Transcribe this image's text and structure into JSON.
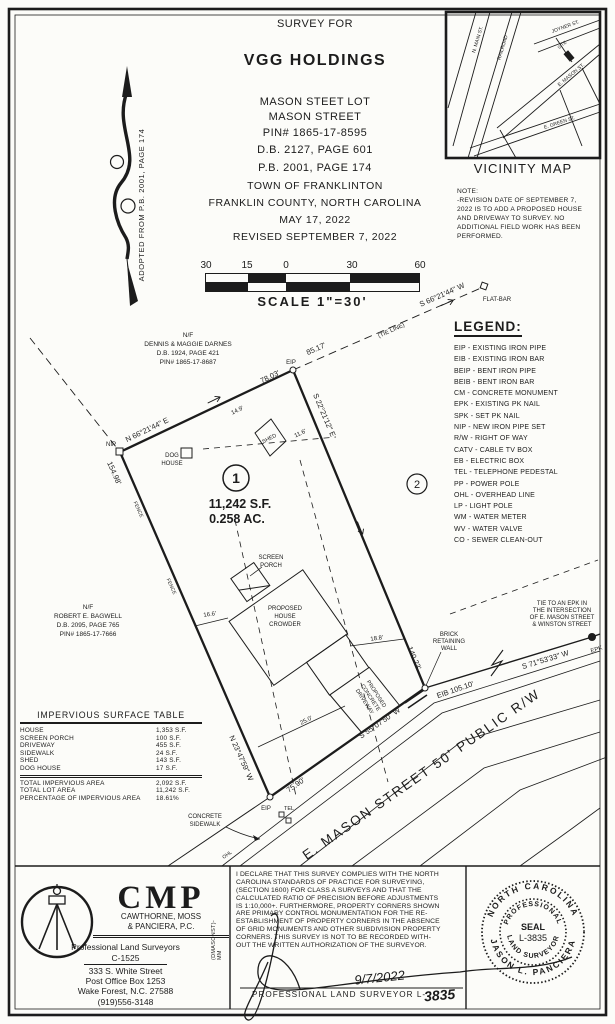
{
  "title_block": {
    "survey_for": "SURVEY FOR",
    "client": "VGG HOLDINGS",
    "lot": "MASON STEET LOT",
    "street": "MASON STREET",
    "pin": "PIN# 1865-17-8595",
    "db": "D.B. 2127, PAGE 601",
    "pb": "P.B. 2001, PAGE 174",
    "town": "TOWN OF FRANKLINTON",
    "county": "FRANKLIN COUNTY, NORTH CAROLINA",
    "date": "MAY 17, 2022",
    "revised": "REVISED SEPTEMBER 7, 2022"
  },
  "scale_bar": {
    "ticks": [
      "30",
      "15",
      "0",
      "30",
      "60"
    ],
    "label": "SCALE   1\"=30'"
  },
  "vicinity": {
    "caption": "VICINITY MAP",
    "streets": {
      "main": "N. MAIN ST.",
      "railroad": "RAILROAD",
      "joyner": "JOYNER ST.",
      "mason": "E. MASON ST.",
      "green": "E. GREEN ST."
    },
    "site": "SITE"
  },
  "note": {
    "heading": "NOTE:",
    "lines": [
      "-REVISION DATE OF SEPTEMBER 7,",
      "2022 IS TO ADD A PROPOSED HOUSE",
      "AND DRIVEWAY TO SURVEY. NO",
      "ADDITIONAL FIELD WORK HAS BEEN",
      "PERFORMED."
    ]
  },
  "adopted_note": "ADOPTED FROM P.B. 2001, PAGE 174",
  "legend": {
    "title": "LEGEND:",
    "items": [
      "EIP - EXISTING IRON PIPE",
      "EIB - EXISTING IRON BAR",
      "BEIP - BENT IRON PIPE",
      "BEIB - BENT IRON BAR",
      "CM - CONCRETE MONUMENT",
      "EPK - EXISTING PK NAIL",
      "SPK - SET PK NAIL",
      "NIP - NEW IRON PIPE SET",
      "R/W - RIGHT OF WAY",
      "CATV - CABLE TV BOX",
      "EB - ELECTRIC BOX",
      "TEL - TELEPHONE PEDESTAL",
      "PP - POWER POLE",
      "OHL - OVERHEAD LINE",
      "LP - LIGHT POLE",
      "WM - WATER METER",
      "WV - WATER VALVE",
      "CO - SEWER CLEAN-OUT"
    ]
  },
  "survey": {
    "bearing_top": "N 66°21'44\" E",
    "dist_top": "78.03'",
    "tie_dist": "85.17'",
    "tie_line": "(TIE LINE)",
    "tie_bearing": "S 66°21'44\" W",
    "flat_bar": "FLAT-BAR",
    "nip": "NIP",
    "eip": "EIP",
    "eip2": "EIP",
    "eib_dist": "EIB  105.10'",
    "epk": "EPK",
    "bearing_right": "S 22°21'12\" E",
    "dist_right": "140.23'",
    "bearing_left": "N 23°47'59\" W",
    "dist_left": "154.98'",
    "bearing_front": "S 55°07'50\" W",
    "dist_front": "75.90'",
    "tie_street_bearing": "S 71°53'33\" W",
    "fence": "FENCE",
    "ohl": "OHL",
    "tel": "TEL",
    "lot1_num": "1",
    "lot1_sf": "11,242 S.F.",
    "lot1_ac": "0.258 AC.",
    "lot2_num": "2",
    "dog_house": [
      "DOG",
      "HOUSE"
    ],
    "shed": "SHED",
    "screen_porch": [
      "SCREEN",
      "PORCH"
    ],
    "house": [
      "PROPOSED",
      "HOUSE",
      "CROWDER"
    ],
    "driveway": [
      "PROPOSED",
      "CONCRETE",
      "DRIVEWAY"
    ],
    "dim_14_9": "14.9'",
    "dim_11_6": "11.6'",
    "dim_16_6": "16.6'",
    "dim_18_8": "18.8'",
    "dim_25_0": "25.0'",
    "brick_wall": [
      "BRICK",
      "RETAINING",
      "WALL"
    ],
    "sidewalk": [
      "CONCRETE",
      "SIDEWALK"
    ],
    "tie_note": [
      "TIE TO AN EPK IN",
      "THE INTERSECTION",
      "OF E. MASON STREET",
      "& WINSTON STREET"
    ],
    "street": "E. MASON STREET 50' PUBLIC R/W",
    "adjoiner1": [
      "N/F",
      "DENNIS & MAGGIE DARNES",
      "D.B. 1924, PAGE 421",
      "PIN# 1865-17-8687"
    ],
    "adjoiner2": [
      "N/F",
      "ROBERT E. BAGWELL",
      "D.B. 2095, PAGE 765",
      "PIN# 1865-17-7666"
    ]
  },
  "impervious_table": {
    "title": "IMPERVIOUS SURFACE TABLE",
    "rows": [
      [
        "HOUSE",
        "1,353 S.F."
      ],
      [
        "SCREEN PORCH",
        "100 S.F."
      ],
      [
        "DRIVEWAY",
        "455 S.F."
      ],
      [
        "SIDEWALK",
        "24 S.F."
      ],
      [
        "SHED",
        "143 S.F."
      ],
      [
        "DOG HOUSE",
        "17 S.F."
      ]
    ],
    "totals": [
      [
        "TOTAL IMPERVIOUS AREA",
        "2,092 S.F."
      ],
      [
        "TOTAL LOT AREA",
        "11,242 S.F."
      ],
      [
        "PERCENTAGE OF IMPERVIOUS AREA",
        "18.61%"
      ]
    ]
  },
  "firm": {
    "name": "CMP",
    "firm_line1": "CAWTHORNE, MOSS",
    "firm_line2": "& PANCIERA, P.C.",
    "profession": "Professional Land Surveyors",
    "license": "C-1525",
    "address1": "333 S. White Street",
    "address2": "Post Office Box 1253",
    "address3": "Wake Forest, N.C. 27588",
    "phone": "(919)556-3148",
    "file_ref": "(DMASONST)-MM"
  },
  "declaration": {
    "lines": [
      "I DECLARE THAT THIS SURVEY COMPLIES WITH THE NORTH",
      "CAROLINA STANDARDS OF PRACTICE FOR SURVEYING,",
      "(SECTION 1600) FOR CLASS A SURVEYS AND THAT THE",
      "CALCULATED RATIO OF PRECISION BEFORE ADJUSTMENTS",
      "IS 1:10,000+. FURTHERMORE, PROPERTY CORNERS SHOWN",
      "ARE PRIMARY CONTROL MONUMENTATION FOR THE RE-",
      "ESTABLISHMENT OF PROPERTY CORNERS IN THE ABSENCE",
      "OF GRID MONUMENTS AND OTHER SUBDIVISION PROPERTY",
      "CORNERS. THIS SURVEY IS NOT TO BE RECORDED WITH-",
      "OUT THE WRITTEN AUTHORIZATION OF THE SURVEYOR."
    ],
    "date": "9/7/2022",
    "cert_line": "PROFESSIONAL LAND SURVEYOR  L-",
    "license_no": "3835"
  },
  "seal": {
    "outer_top": "NORTH CAROLINA",
    "outer_bottom": "JASON L. PANCIERA",
    "inner_top": "PROFESSIONAL",
    "inner_bottom": "LAND SURVEYOR",
    "center1": "SEAL",
    "center2": "L-3835"
  },
  "colors": {
    "ink": "#1c1c1c",
    "paper": "#fcfcf9"
  }
}
